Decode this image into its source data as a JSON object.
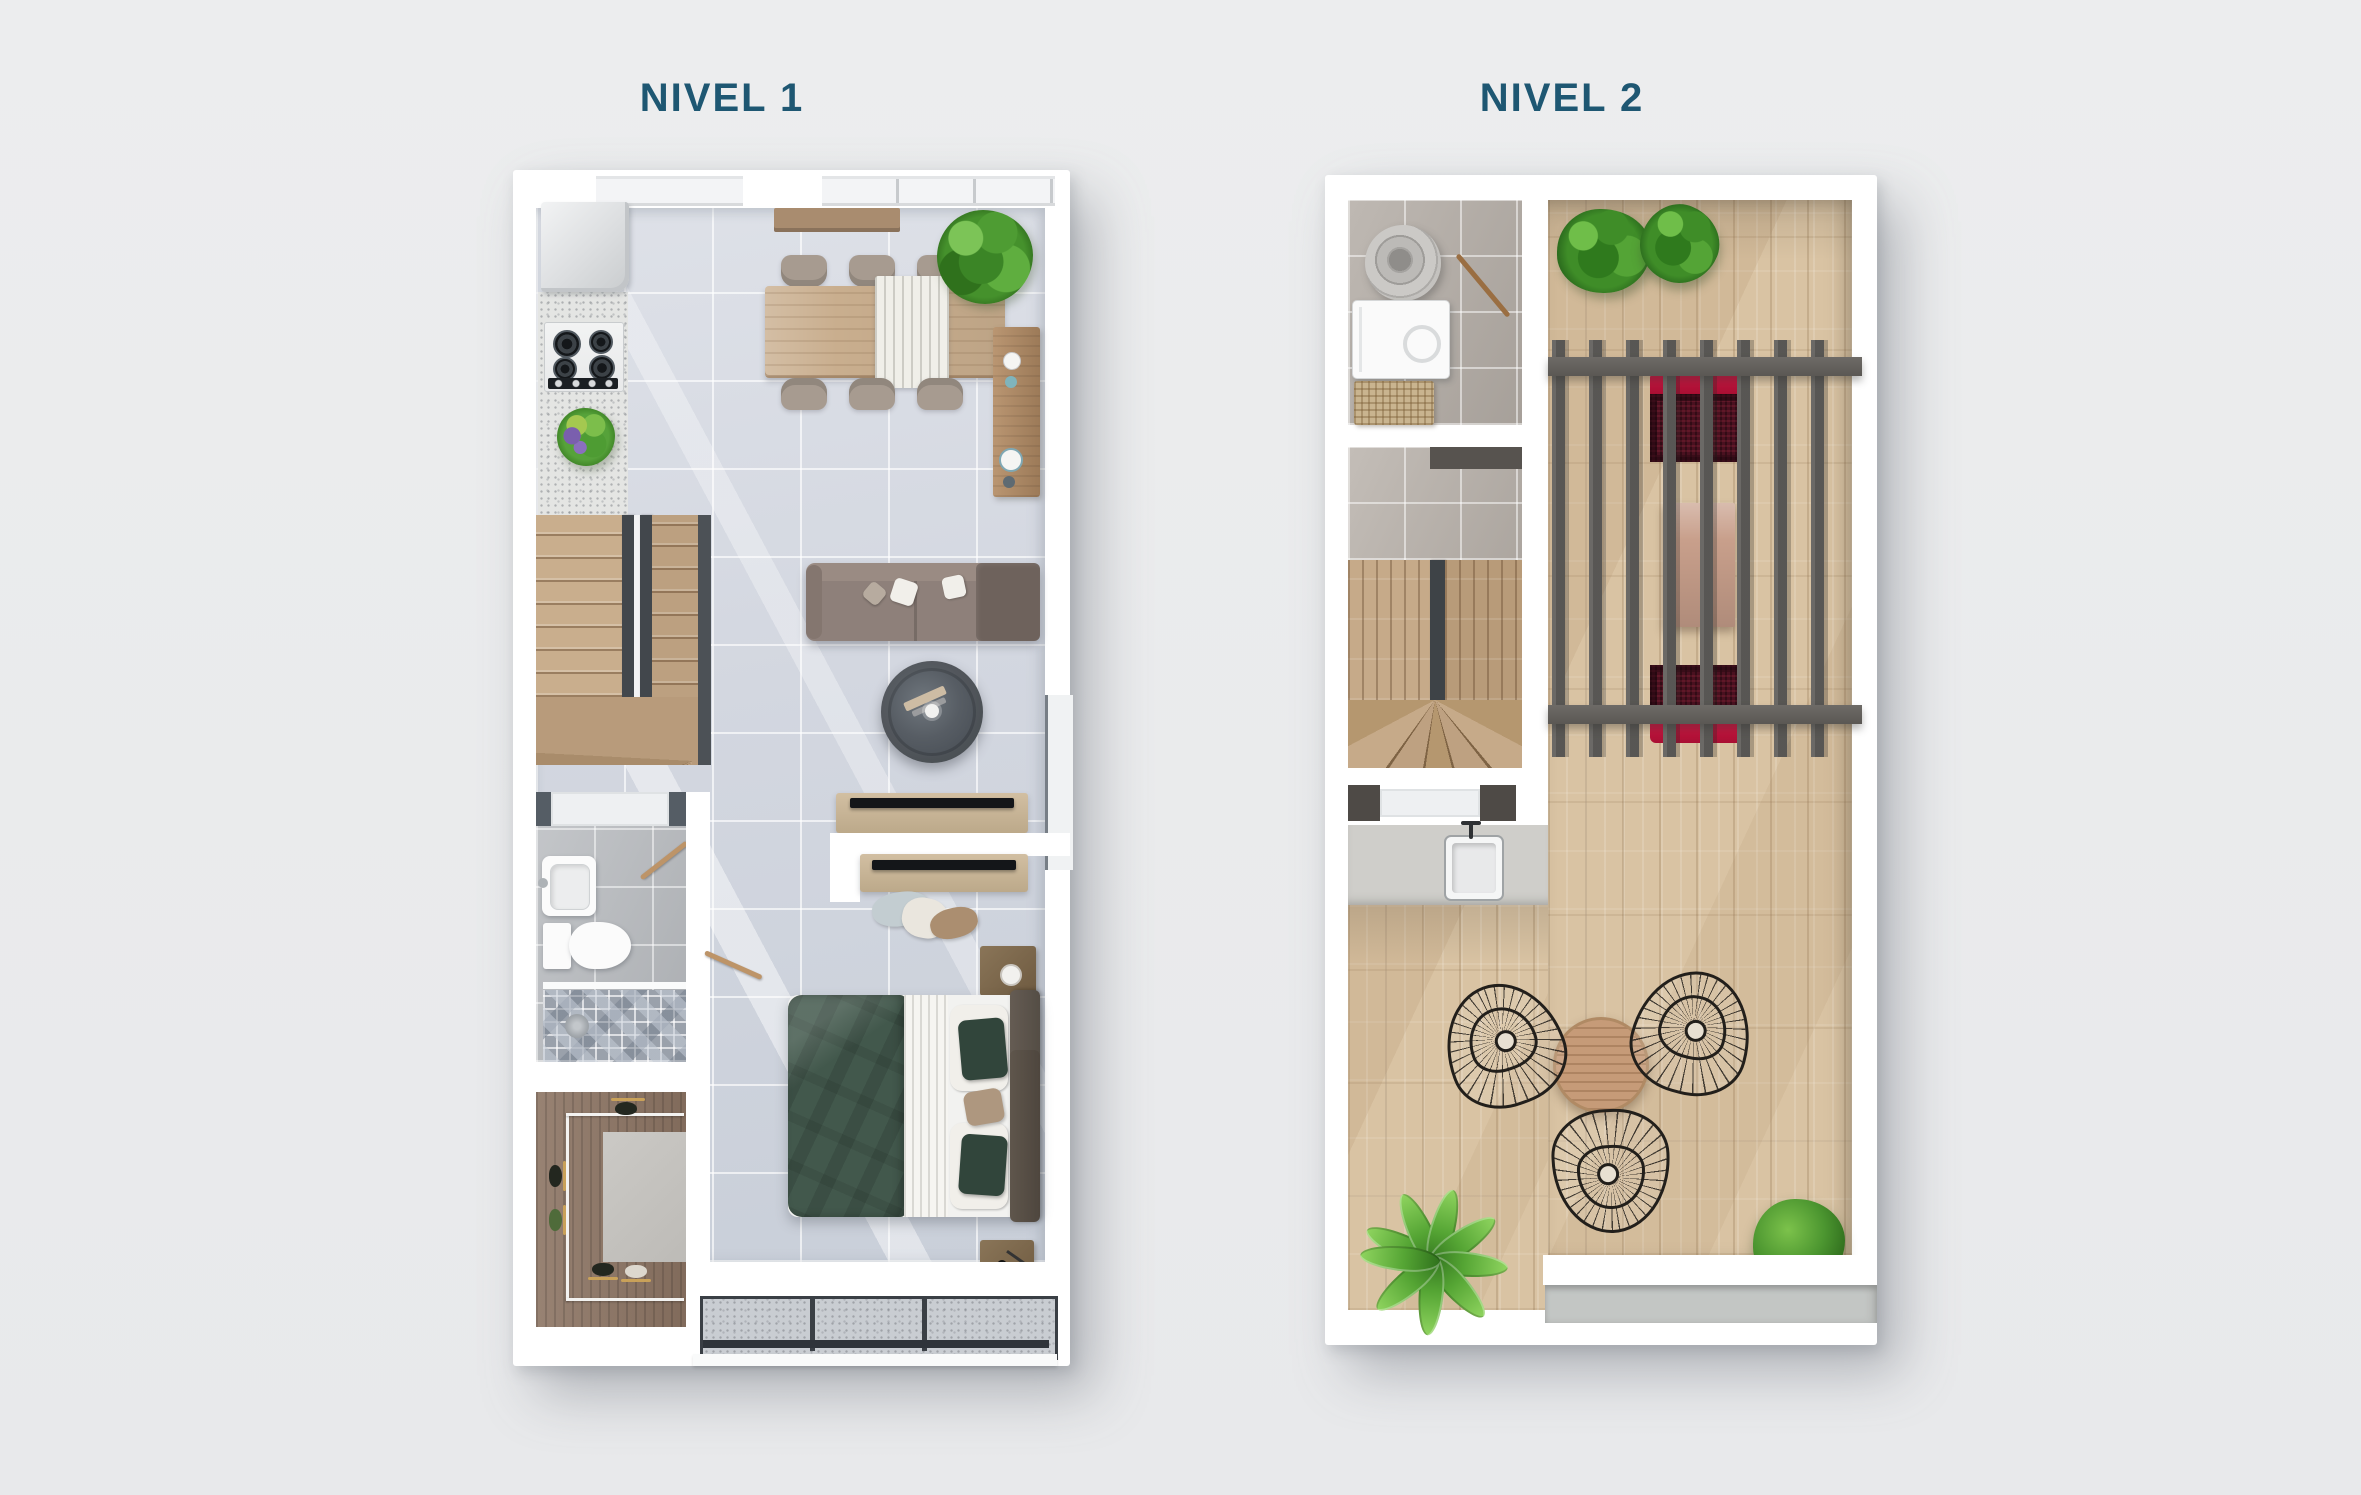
{
  "canvas": {
    "width": 2361,
    "height": 1495,
    "background": "#EAEBEC"
  },
  "titles": {
    "level1": "NIVEL 1",
    "level2": "NIVEL 2",
    "color": "#1E5772"
  },
  "palette": {
    "wall": "#FFFFFF",
    "floor_level1": "#D6DAE2",
    "bathroom_floor": "#B6B9BD",
    "mosaic_shower": "#9AA1AB",
    "stair_wood": "#C9AE8D",
    "closet_wood": "#8C7463",
    "dining_table_wood": "#C9AE8E",
    "sofa_gray": "#8E807A",
    "coffee_table_dark": "#575D64",
    "bed_duvet_green": "#42584C",
    "headboard_brown": "#584F46",
    "balcony_granite": "#C9CDD2",
    "deck_wood": "#D9C3A3",
    "pergola_slats": "#6B6966",
    "lounge_red_accent": "#C0123B",
    "lounge_red_body": "#4A1120",
    "plant_green": "#4C9630",
    "utility_floor": "#B3ACA5",
    "title_text": "#1E5772"
  },
  "level1": {
    "title": "NIVEL 1",
    "rooms": [
      "kitchen",
      "dining",
      "living",
      "stairs",
      "bathroom",
      "walk-in-closet",
      "bedroom",
      "balcony"
    ],
    "furniture": [
      "fridge",
      "stove",
      "kitchen-sink",
      "dining-table",
      "dining-chairs-x6",
      "sideboard",
      "entry-console",
      "sofa",
      "coffee-table",
      "tv-console-living",
      "tv-console-bedroom",
      "floor-cushions",
      "double-bed",
      "nightstand-x2",
      "vanity-sink",
      "toilet",
      "shower",
      "wardrobe",
      "sliding-window"
    ]
  },
  "level2": {
    "title": "NIVEL 2",
    "rooms": [
      "laundry-utility",
      "stairwell",
      "wet-bar-counter",
      "roof-terrace",
      "pergola-lounge"
    ],
    "furniture": [
      "water-heater",
      "washing-machine",
      "laundry-basket",
      "bar-sink",
      "pergola",
      "outdoor-sofa-x2",
      "outdoor-coffee-table",
      "wire-chair-x3",
      "round-side-table",
      "banana-plant",
      "round-bush",
      "hedge-planters-x2"
    ]
  }
}
